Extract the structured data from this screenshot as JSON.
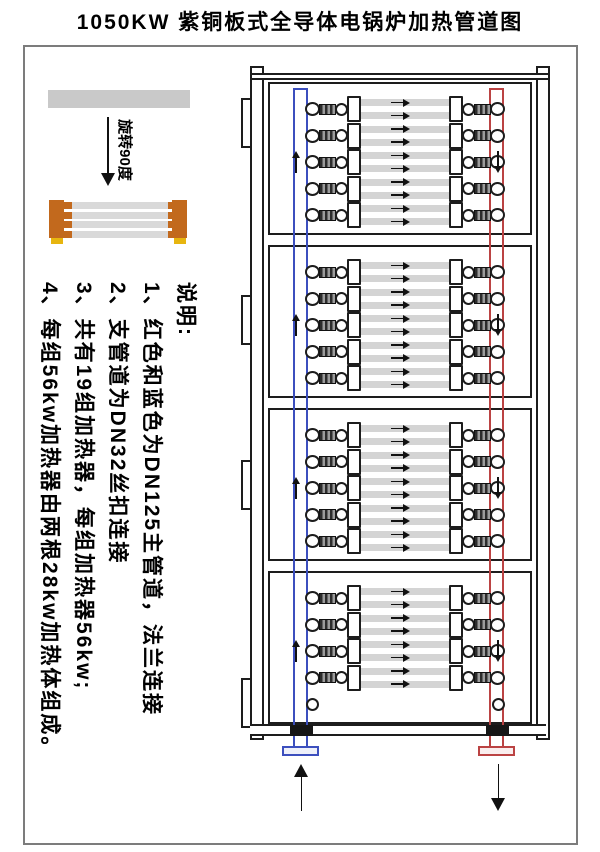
{
  "title": "1050KW 紫铜板式全导体电锅炉加热管道图",
  "legend": {
    "rotate_label": "旋转90度",
    "plate_color": "#c9c9c9",
    "copper_color": "#c2691d",
    "foot_color": "#e7b50f",
    "tube_color": "#d9d9d9",
    "demo_tube_count": 4
  },
  "notes": {
    "heading": "说明:",
    "items": [
      "1、红色和蓝色为DN125主管道，法兰连接",
      "2、支管道为DN32丝扣连接",
      "3、共有19组加热器，每组加热器56kw;",
      "4、每组56kw加热器由两根28kw加热体组成。"
    ]
  },
  "diagram": {
    "supply_pipe_color": "#3c4fbe",
    "return_pipe_color": "#bb4343",
    "flange_fill_blue": "#eef0fa",
    "flange_fill_red": "#faeeee",
    "tube_fill": "#d4d4d4",
    "heater_group_total": 19,
    "tubes_per_row": 2,
    "panels": [
      {
        "heater_rows": 5,
        "spare_stub": false
      },
      {
        "heater_rows": 5,
        "spare_stub": false
      },
      {
        "heater_rows": 5,
        "spare_stub": false
      },
      {
        "heater_rows": 4,
        "spare_stub": true
      }
    ],
    "inlet_flow": "up",
    "outlet_flow": "down",
    "tube_flow": "right"
  }
}
